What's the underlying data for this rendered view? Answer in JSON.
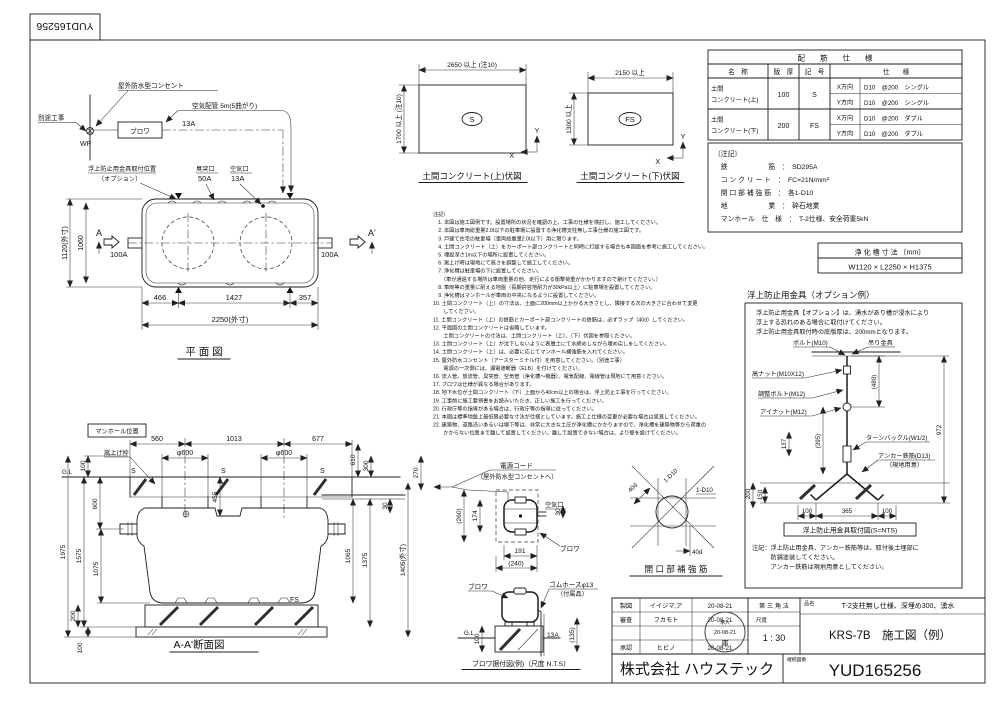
{
  "sheet": {
    "doc_number": "YUD165256"
  },
  "schematic": {
    "separate_work": "別途工事",
    "wp": "WP",
    "blower": "ブロワ",
    "amp": "13A",
    "outlet": "屋外防水型コンセント",
    "air_pipe": "空気配管 5m(5曲がり)",
    "anti_float_pos1": "浮上防止用金具取付位置",
    "anti_float_pos2": "（オプション）",
    "vent": "臭突口",
    "vent_size": "50A",
    "air_port": "空気口",
    "air_size": "13A"
  },
  "plan": {
    "title": "平 面 図",
    "a": "A",
    "a2": "A'",
    "inlet": "100A",
    "outlet": "100A",
    "dim_w": "1120(外寸)",
    "dim_w2": "1060",
    "dim_466": "466",
    "dim_1427": "1427",
    "dim_357": "357",
    "dim_len": "2250(外寸)"
  },
  "slab_upper": {
    "title": "土間コンクリート(上)伏図",
    "dim_w": "2650 以上 (注10)",
    "dim_h": "1700 以上 (注10)",
    "mark": "S",
    "x": "X",
    "y": "Y"
  },
  "slab_lower": {
    "title": "土間コンクリート(下)伏図",
    "dim_w": "2150 以上",
    "dim_h": "1300 以上",
    "mark": "FS",
    "x": "X",
    "y": "Y"
  },
  "rebar_table": {
    "title": "配　　筋　　仕　　様",
    "col_name": "名　称",
    "col_thickness": "版　厚",
    "col_symbol": "記　号",
    "col_spec": "仕　　様",
    "rows": [
      {
        "name1": "土間",
        "name2": "コンクリート(上)",
        "thickness": "100",
        "symbol": "S",
        "x_dir": "X方向",
        "x_spec": "D10　@200　シングル",
        "y_dir": "Y方向",
        "y_spec": "D10　@200　シングル"
      },
      {
        "name1": "土間",
        "name2": "コンクリート(下)",
        "thickness": "200",
        "symbol": "FS",
        "x_dir": "X方向",
        "x_spec": "D10　@200　ダブル",
        "y_dir": "Y方向",
        "y_spec": "D10　@200　ダブル"
      }
    ]
  },
  "spec_notes": {
    "lines": [
      "〔注記〕",
      "　鉄　　　　　　筋　：　SD295A",
      "　コ ン ク リ ー ト　：　FC=21N/mm²",
      "　開 口 部 補 強 筋　：　各1-D10",
      "　地　　　　　　業　：　砕石地業",
      "　マンホール　仕　様　：　T-2仕様、安全荷重5kN"
    ]
  },
  "tank_size": {
    "title": "浄 化 槽 寸 法 〔mm〕",
    "value": "W1120 × L2250 × H1375"
  },
  "anti_float": {
    "title": "浮上防止用金具（オプション例）",
    "note_lines": [
      "浮上防止用金具【オプション】は、湧水があり槽が浸水により",
      "浮上する恐れのある場合に取付けてください。",
      "浮上防止用金具取付時の底版厚は、200mmとなります。"
    ],
    "labels": {
      "bolt": "ボルト(M10)",
      "hanger": "吊り金具",
      "nut": "高ナット(M10X12)",
      "adjust": "調整ボルト(M12)",
      "eyenut": "アイナット(M12)",
      "turnbuckle": "ターンバックル(W1/2)",
      "anchor": "アンカー鉄筋(D13)",
      "anchor2": "（現地用意）"
    },
    "dims": {
      "d480": "(480)",
      "d972": "972",
      "d137": "137",
      "d395": "(395)",
      "d200": "200",
      "d150": "150",
      "d100a": "100",
      "d365": "365",
      "d100b": "100"
    },
    "caption": "浮上防止用金具取付図(S=NTS)",
    "bottom_notes": [
      "注記：浮上防止用金具、アンカー鉄筋等は、取付後土埋部に",
      "　　　防錆塗装してください。",
      "　　　アンカー鉄筋は現地用意としてください。"
    ]
  },
  "notes": {
    "lines": [
      "注記）",
      "　1. 本図は施工図例です。設置場所の状況を確認の上、工事の仕様を検討し、施工してください。",
      "　2. 本図は車両総重量2.0t以下の駐車場に設置する浄化槽支柱無し工事仕様の施工図です。",
      "　3. 戸建て住宅の駐車場（車両総重量2.0t以下）用に限ります。",
      "　4. 土間コンクリート（上）をカーポート部コンクリートと同時に打設する場合も本図面を参考に施工してください。",
      "　5. 埋設深さ1m以下の場所に設置してください。",
      "　6. 嵩上げ時は現地にて高さを調整して施工してください。",
      "　7. 浄化槽は駐車場の下に設置してください。",
      "　　（車が通過する場所は車両重量の他、走行による衝撃荷重がかかりますので避けてください。）",
      "　8. 車両等の重量に耐える地盤（長期許容地耐力が30kPa以上）に駐車場を設置してください。",
      "　9. 浄化槽はマンホールが車両の中央になるように設置してください。",
      "10. 土間コンクリート（上）の寸法は、土面に200mm以上かかる大きさとし、隣接する次の大きさに合わせて変更",
      "　　してください。",
      "11. 土間コンクリート（上）の鉄筋とカーポート部コンクリートの鉄筋は、必ずラップ（40d）してください。",
      "12. 平面図の土間コンクリートは省略しています。",
      "　　土間コンクリートの寸法は、土間コンクリート（上）、（下）伏図を参照ください。",
      "13. 土間コンクリート（上）が沈下しないように表層土にて水締めしながら埋め戻しをしてください。",
      "14. 土間コンクリート（上）は、必要に応じてマンホール補強筋を入れてください。",
      "15. 屋外防水コンセント（アースターミナル付）を用意してください。（別途工事）",
      "　　電源の一次側には、漏電遮断器（ELB）を付けてください。",
      "16. 流入管、放流管、臭突管、空気管（浄化槽～機器）、電気配線、電線管は現地にて用意ください。",
      "17. ブロワは仕様が異なる場合があります。",
      "18. 地下水位が土間コンクリート（下）上面から40cm以上の場合は、浮上防止工事を行ってください。",
      "19. 工事前に施工要領書をお読みいただき、正しい施工を行ってください。",
      "20. 行政庁等の指導がある場合は、行政庁等の指導に従ってください。",
      "21. 本図は標準地盤上最低限必要な寸法が仕様としています。施工上仕様の変更が必要な場合は見直してください。",
      "22. 建築物、道路沿いあるいは塀下等は、非常に大きな土圧が浄化槽にかかりますので、浄化槽を建築物等から荷重の",
      "　　かからない位置まで離して設置してください。離して設置できない場合は、より壁を設けてください。"
    ]
  },
  "section": {
    "manhole_pos": "マンホール位置",
    "riser": "嵩上げ枠",
    "title": "A-A'断面図",
    "gl": "G.L",
    "fs": "FS",
    "s_mark": "S",
    "dims": {
      "d560": "560",
      "d1013": "1013",
      "d677": "677",
      "phi1": "φ600",
      "phi2": "φ600",
      "d100t": "100",
      "d600": "600",
      "d1575": "1575",
      "d1075": "1075",
      "d1975": "1975",
      "d200": "200",
      "d100b": "100",
      "d455": "455",
      "d610": "610",
      "d300": "300",
      "d30": "30",
      "d1065": "1065",
      "d1375": "1375",
      "d1405": "1405(外寸)",
      "d270": "270"
    }
  },
  "blower_plan": {
    "cord": "電源コード",
    "cord2": "（屋外防水型コンセントへ）",
    "air": "空気口",
    "blower": "ブロワ",
    "d260": "(260)",
    "d174": "174",
    "d30": "30",
    "d191": "191",
    "d240": "(240)"
  },
  "blower_mount": {
    "blower": "ブロワ",
    "hose": "ゴムホースφ13",
    "hose2": "（付属品）",
    "gl": "G.L",
    "d100": "100",
    "pipe": "13A",
    "d135": "(135)",
    "title": "ブロワ据付図(例)（尺度 N.T.S）"
  },
  "opening": {
    "title": "開 口 部 補 強 筋",
    "d40a": "40d",
    "d40b": "40d",
    "bar1": "1-D10",
    "bar2": "1-D10"
  },
  "title_block": {
    "rows": [
      {
        "label": "製図",
        "name": "イイジマ,ア",
        "date": "20-08-21"
      },
      {
        "label": "審査",
        "name": "フカモト",
        "date": "20-08-21"
      },
      {
        "label": "承認",
        "name": "ヒビノ",
        "date": "20-08-21"
      }
    ],
    "projection": "第 三 角 法",
    "scale_label": "尺度",
    "scale": "1 : 30",
    "stamp": {
      "line1": "承入",
      "line2": "20-08-21",
      "line3": "庫"
    },
    "product_label": "品名",
    "product_line1": "T-2支柱無し仕様、深埋め300、湧水",
    "product_line2": "KRS-7B　施工図（例）",
    "company": "株式会社 ハウステック",
    "cont_label": "継続図番",
    "drawing_no": "YUD165256"
  }
}
